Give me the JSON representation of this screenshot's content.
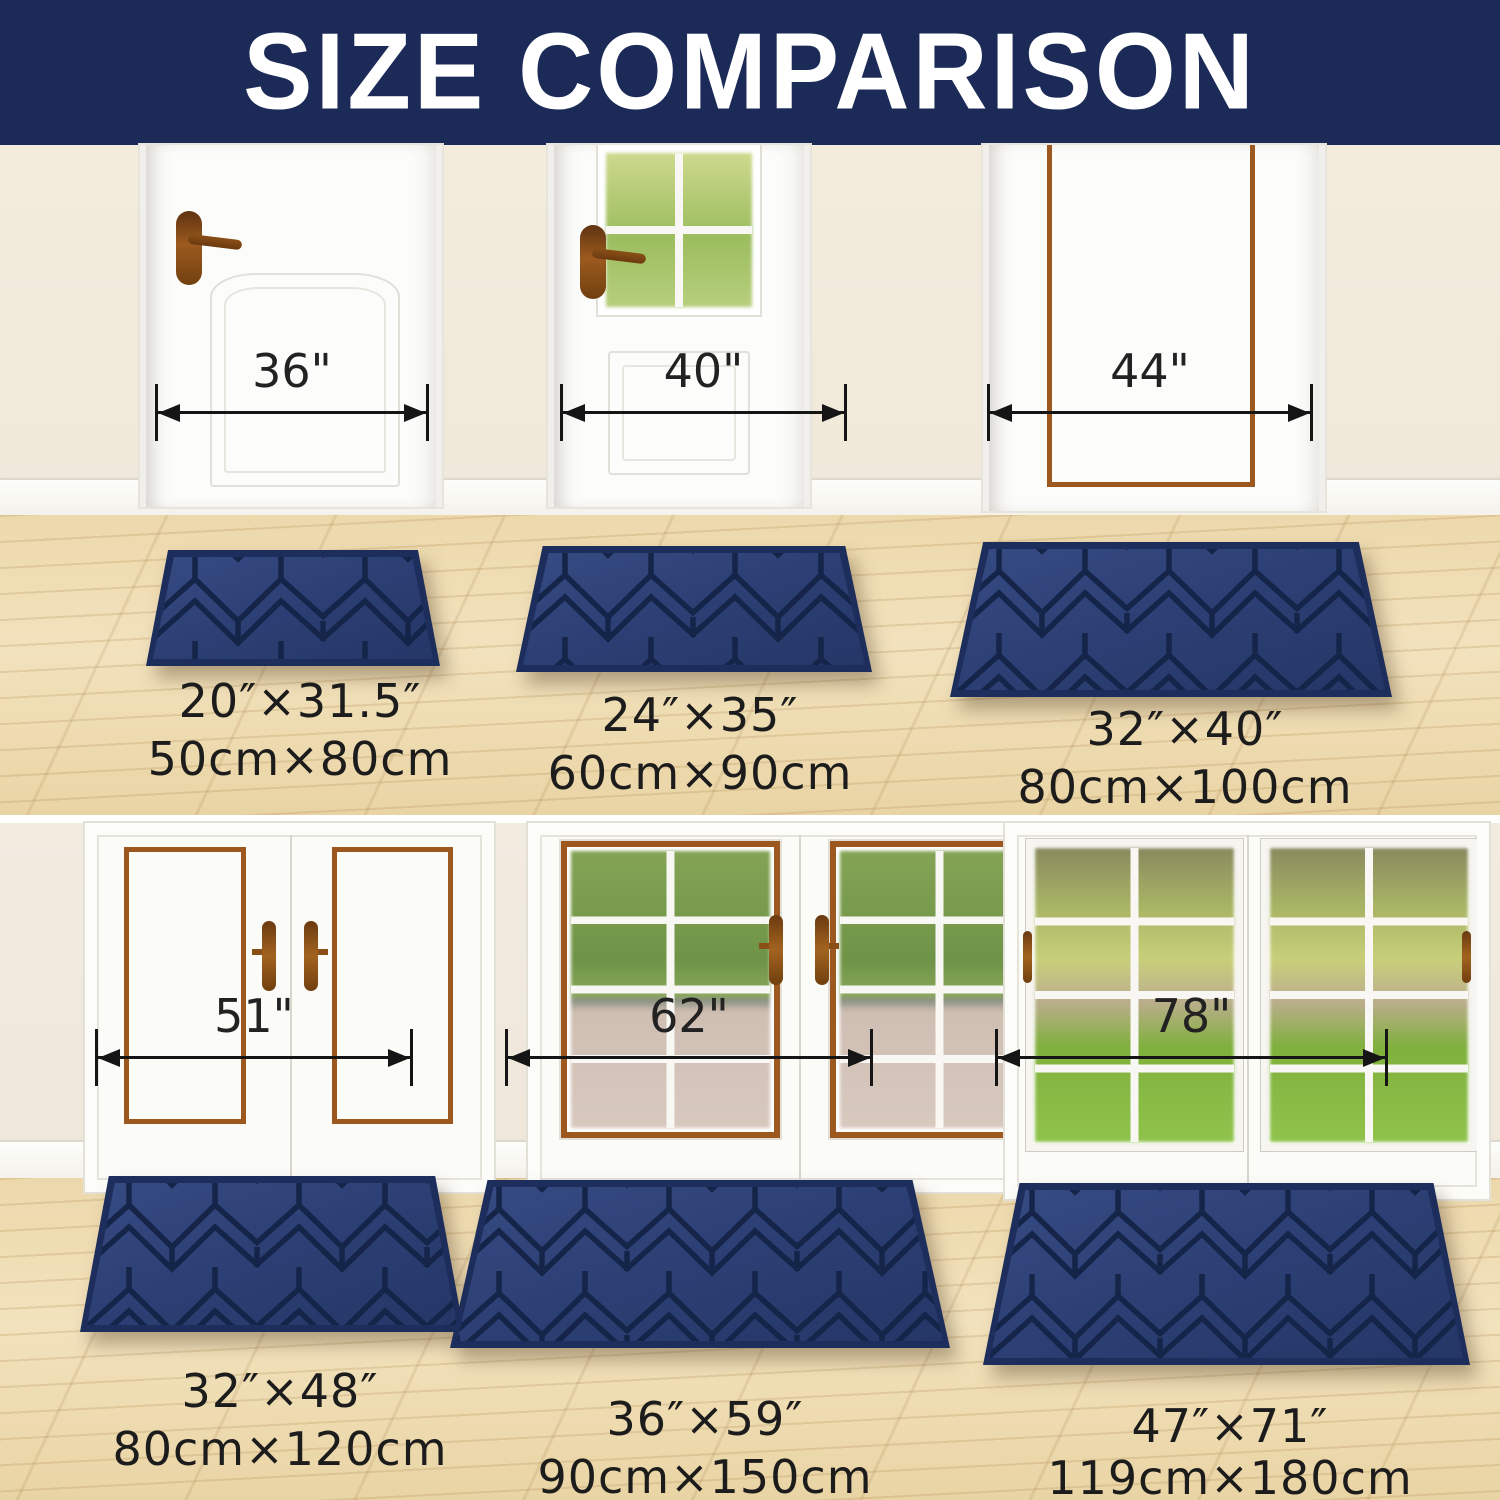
{
  "title": "SIZE COMPARISON",
  "top_row": [
    {
      "door_width": "36\"",
      "mat_size_in": "20″×31.5″",
      "mat_size_cm": "50cm×80cm"
    },
    {
      "door_width": "40\"",
      "mat_size_in": "24″×35″",
      "mat_size_cm": "60cm×90cm"
    },
    {
      "door_width": "44\"",
      "mat_size_in": "32″×40″",
      "mat_size_cm": "80cm×100cm"
    }
  ],
  "bottom_row": [
    {
      "door_width": "51\"",
      "mat_size_in": "32″×48″",
      "mat_size_cm": "80cm×120cm"
    },
    {
      "door_width": "62\"",
      "mat_size_in": "36″×59″",
      "mat_size_cm": "90cm×150cm"
    },
    {
      "door_width": "78\"",
      "mat_size_in": "47″×71″",
      "mat_size_cm": "119cm×180cm"
    }
  ],
  "colors": {
    "header_bg": "#1b2a57",
    "header_text": "#ffffff",
    "mat_base": "#2d4078",
    "mat_pattern_line": "#152449",
    "wall": "#f2ebdc",
    "floor_wood": "#ecd8ab",
    "door_trim_brown": "#9c581e",
    "measure_line": "#151515",
    "label_text": "#1c1c1c"
  }
}
